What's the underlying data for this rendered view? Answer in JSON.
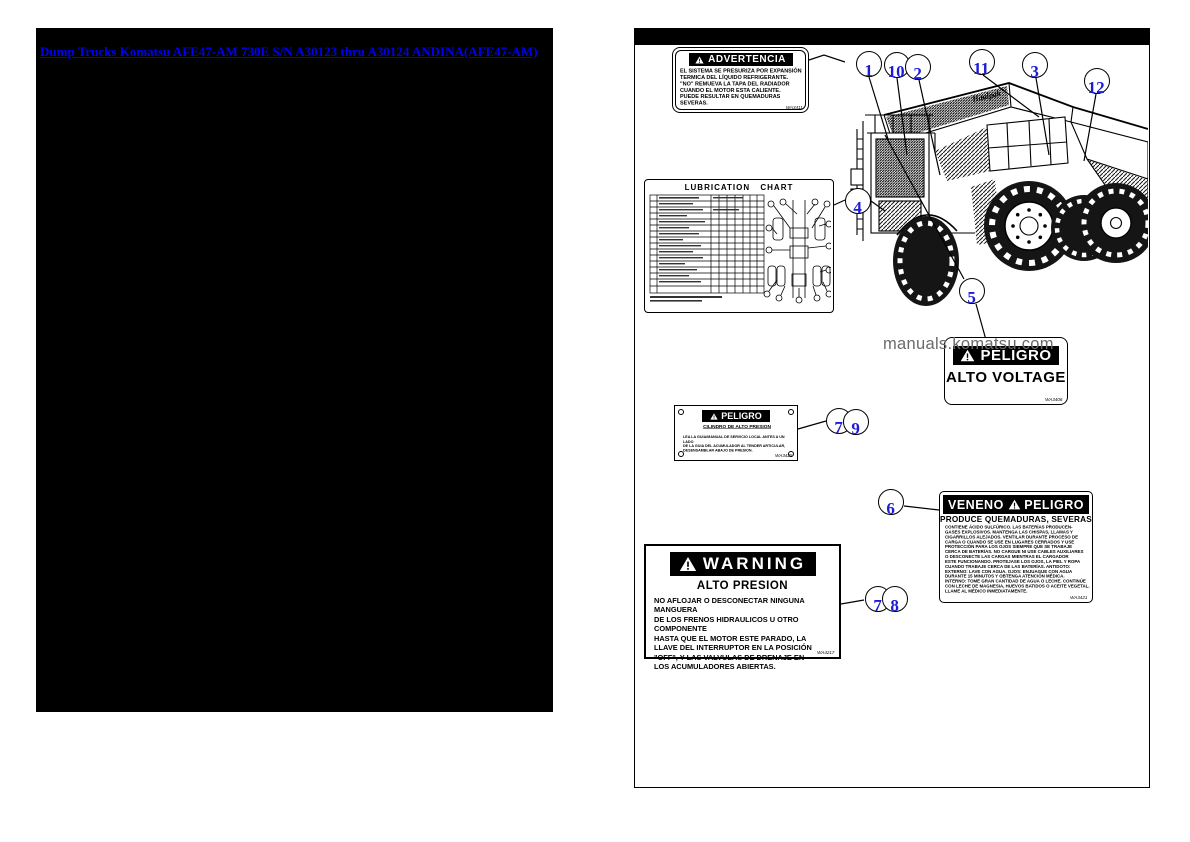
{
  "left_page": {
    "link": "Dump Trucks Komatsu AFE47-AM 730E S/N A30123 thru A30124 ANDINA(AFE47-AM)"
  },
  "watermark": "manuals.komatsu.com",
  "truck": {
    "brand": "Haulpak"
  },
  "labels": {
    "advertencia": {
      "header": "ADVERTENCIA",
      "body": [
        "EL SISTEMA SE PRESURIZA POR EXPANSIÓN",
        "TERMICA DEL LÍQUIDO REFRIGERANTE.",
        "\"NO\" REMUEVA LA TAPA DEL RADIADOR",
        "CUANDO EL MOTOR ESTA CALIENTE.",
        "PUEDE RESULTAR EN QUEMADURAS",
        "SEVERAS."
      ],
      "code": "WA3411"
    },
    "chart": {
      "title": "LUBRICATION CHART"
    },
    "alto_voltage": {
      "header": "PELIGRO",
      "text": "ALTO VOLTAGE",
      "code": "WA3406"
    },
    "cilindro": {
      "header": "PELIGRO",
      "subtitle": "CILINDRO DE ALTO PRESION",
      "body": [
        "LEA LA GUIA/MANUAL DE SERVICIO LOCAL ANTES A UN LADO",
        "DE LA GUIA DEL ACUMULADOR AL TENDER ARTICULAR,",
        "DESENSAMBLAR ABAJO DE PRESION."
      ],
      "code": "WA3425"
    },
    "veneno": {
      "header_left": "VENENO",
      "header_right": "PELIGRO",
      "subtitle": "PRODUCE QUEMADURAS, SEVERAS",
      "body": [
        "CONTIENE ÁCIDO SULFÚRICO. LAS BATERÍAS PRODUCEN-",
        "GASES EXPLOSIVOS. MANTENGA LAS CHISPAS, LLAMAS Y",
        "CIGARRILLOS ALEJADOS. VENTILAR DURANTE PROCESO DE",
        "CARGA O CUANDO SE USE EN LUGARES CERRADOS Y USE",
        "PROTECCIÓN PARA LOS OJOS SIEMPRE QUE SE TRABAJE",
        "CERCA DE BATERÍAS. NO CARGUE NI USE CABLES AUXILIARES",
        "O DESCONECTE LAS CARGAS MIENTRAS EL CARGADOR",
        "ESTE FUNCIONANDO. PROTEJASE LOS OJOS, LA PIEL Y ROPA",
        "CUANDO TRABAJE CERCA DE LAS BATERÍAS. ANTIDOTO:",
        "EXTERNO: LAVE CON AGUA. OJOS: ENJUAGUE CON AGUA",
        "DURANTE 15 MINUTOS Y OBTENGA ATENCIÓN MÉDICA.",
        "INTERNO: TOME GRAN CANTIDAD DE AGUA O LECHE. CONTINÚE",
        "CON LECHE DE MAGNESIA, HUEVOS BATIDOS O ACEITE VEGETAL.",
        "LLAME AL MÉDICO INMEDIATAMENTE."
      ],
      "code": "WA3421"
    },
    "warning": {
      "header": "WARNING",
      "subtitle": "ALTO PRESION",
      "body": [
        "NO AFLOJAR O DESCONECTAR NINGUNA MANGUERA",
        "DE LOS FRENOS HIDRAULICOS U OTRO COMPONENTE",
        "HASTA QUE EL MOTOR ESTE PARADO, LA",
        "LLAVE DEL INTERRUPTOR EN LA POSICIÓN",
        "\"OFF\", Y LAS VALVULAS DE DRENAJE EN",
        "LOS ACUMULADORES ABIERTAS."
      ],
      "code": "WA4217"
    }
  },
  "callouts": [
    {
      "n": "1",
      "x": 221,
      "y": 22
    },
    {
      "n": "10",
      "x": 249,
      "y": 23
    },
    {
      "n": "2",
      "x": 270,
      "y": 25
    },
    {
      "n": "11",
      "x": 334,
      "y": 20
    },
    {
      "n": "3",
      "x": 387,
      "y": 23
    },
    {
      "n": "12",
      "x": 449,
      "y": 39
    },
    {
      "n": "4",
      "x": 210,
      "y": 159
    },
    {
      "n": "5",
      "x": 324,
      "y": 249
    },
    {
      "n": "7",
      "x": 191,
      "y": 379
    },
    {
      "n": "9",
      "x": 208,
      "y": 380
    },
    {
      "n": "6",
      "x": 243,
      "y": 460
    },
    {
      "n": "7",
      "x": 230,
      "y": 557
    },
    {
      "n": "8",
      "x": 247,
      "y": 557
    }
  ],
  "colors": {
    "link": "#0000ee",
    "callout_number": "#1b1bd9",
    "watermark": "#6a6a6a"
  }
}
